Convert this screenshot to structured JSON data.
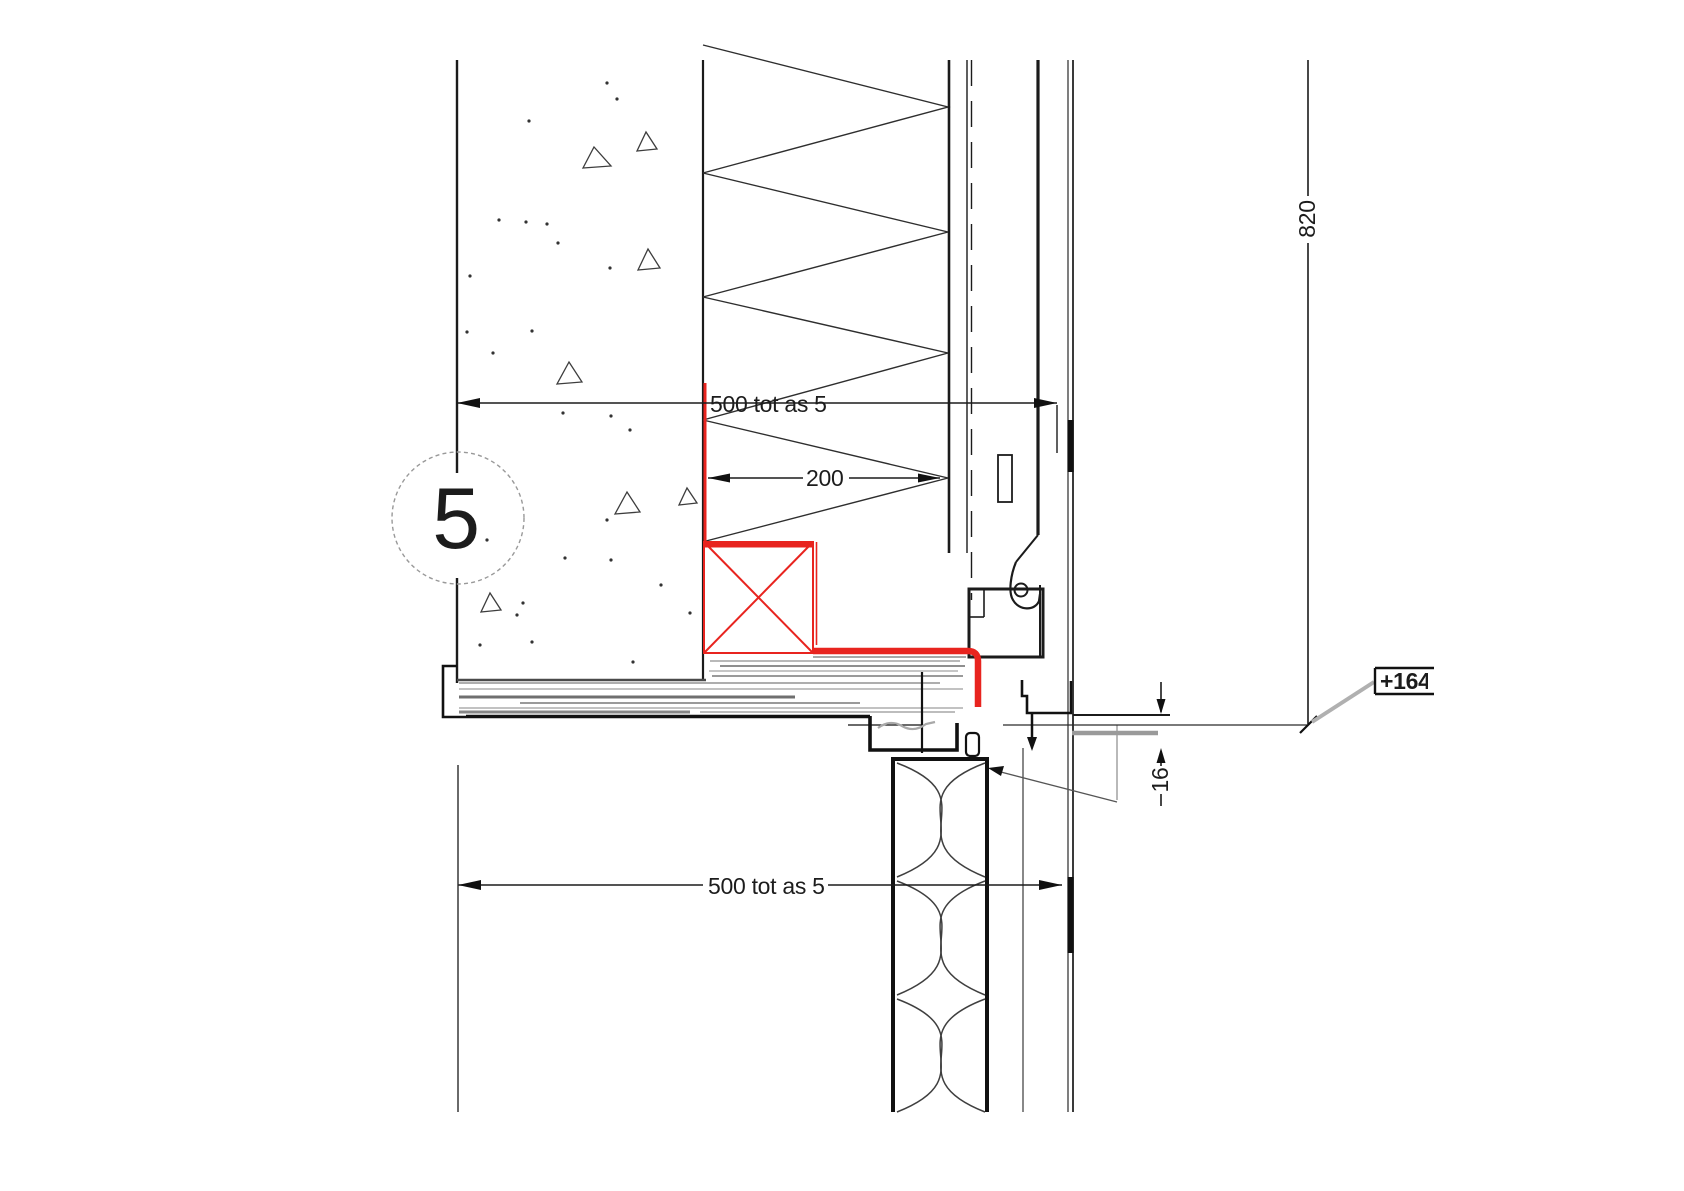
{
  "drawing": {
    "detail_bubble": {
      "number": "5"
    },
    "dimensions": {
      "top_width": "500 tot as 5",
      "insulation_width": "200",
      "right_height": "820",
      "gap": "16",
      "bottom_width": "500 tot as 5"
    },
    "level_marker": {
      "label": "+1648"
    },
    "colors": {
      "highlight_red": "#e8241f",
      "line": "#1b1b1b",
      "gray_fill": "#9a9a9a",
      "leader_gray": "#b0b0b0"
    }
  }
}
